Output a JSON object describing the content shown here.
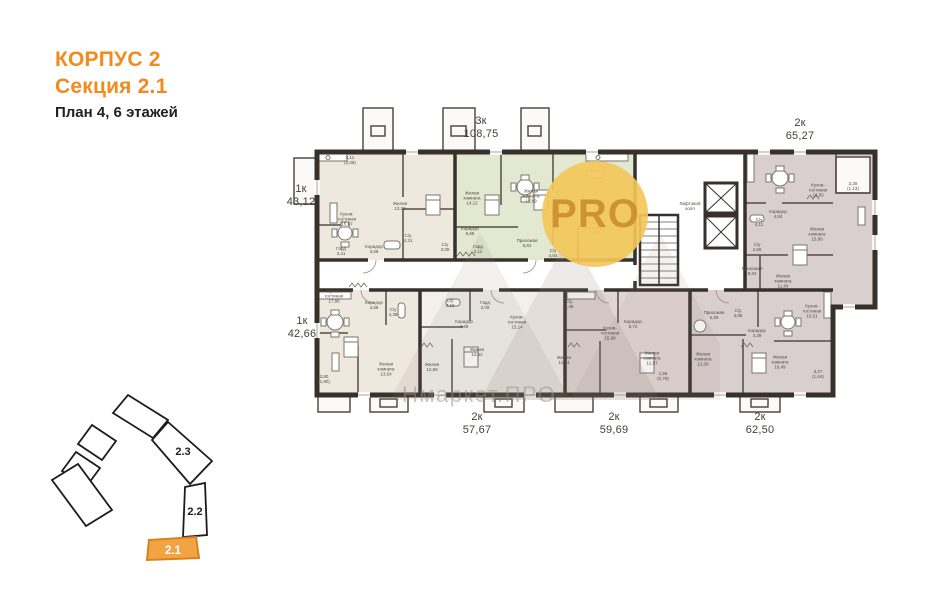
{
  "header": {
    "building": "КОРПУС 2",
    "section": "Секция 2.1",
    "plan": "План 4, 6 этажей"
  },
  "watermarks": {
    "pro_badge": "PRO",
    "site": "Нмаркет.ПРО"
  },
  "colors": {
    "accent_orange": "#f28a1d",
    "wall": "#38302a",
    "unit_beige": "#efe8de",
    "unit_green": "#e3e8d1",
    "unit_mauve": "#d9cfce",
    "unit_mauve_light": "#e0d6d4",
    "unit_white": "#f3f0ec",
    "pro_circle": "#f3c75a",
    "minimap_selected": "#f2a444"
  },
  "plan": {
    "unit_labels": [
      {
        "name": "unit-label-1k-43",
        "text": "1к\n43,12",
        "x": 301,
        "y": 196
      },
      {
        "name": "unit-label-3k-108",
        "text": "3к\n108,75",
        "x": 481,
        "y": 128
      },
      {
        "name": "unit-label-2k-65",
        "text": "2к\n65,27",
        "x": 800,
        "y": 130
      },
      {
        "name": "unit-label-1k-42",
        "text": "1к\n42,66",
        "x": 302,
        "y": 328
      },
      {
        "name": "unit-label-2k-57",
        "text": "2к\n57,67",
        "x": 477,
        "y": 424
      },
      {
        "name": "unit-label-2k-59",
        "text": "2к\n59,69",
        "x": 614,
        "y": 424
      },
      {
        "name": "unit-label-2k-62",
        "text": "2к\n62,50",
        "x": 760,
        "y": 424
      }
    ],
    "room_labels": [
      {
        "text": "Кухня-\nгостиная\n15,67",
        "x": 347,
        "y": 219
      },
      {
        "text": "Жилая\n13,99",
        "x": 400,
        "y": 206
      },
      {
        "text": "Коридор\n3,68",
        "x": 374,
        "y": 249
      },
      {
        "text": "Гард\n3,41",
        "x": 341,
        "y": 251
      },
      {
        "text": "С/у\n4,31",
        "x": 408,
        "y": 238
      },
      {
        "text": "4,11\n(2,06)",
        "x": 350,
        "y": 160
      },
      {
        "text": "Жилая\nкомната\n14,12",
        "x": 472,
        "y": 198
      },
      {
        "text": "Жилая\nкомната\n12,89",
        "x": 531,
        "y": 196
      },
      {
        "text": "Кухня-\nгостиная\n31,57",
        "x": 594,
        "y": 228
      },
      {
        "text": "Коридор\n5,65",
        "x": 470,
        "y": 231
      },
      {
        "text": "С/у\n3,09",
        "x": 445,
        "y": 247
      },
      {
        "text": "Гард\n2,11",
        "x": 478,
        "y": 249
      },
      {
        "text": "Прихожая\n5,81",
        "x": 527,
        "y": 243
      },
      {
        "text": "С/у\n4,54",
        "x": 553,
        "y": 253
      },
      {
        "text": "Лифтовой\nхолл",
        "x": 690,
        "y": 206
      },
      {
        "text": "Кухня-\nгостиная\n18,83",
        "x": 818,
        "y": 190
      },
      {
        "text": "Коридор\n4,84",
        "x": 778,
        "y": 214
      },
      {
        "text": "С/у\n4,11",
        "x": 759,
        "y": 222
      },
      {
        "text": "Жилая\nкомната\n15,80",
        "x": 817,
        "y": 234
      },
      {
        "text": "С/у\n2,56",
        "x": 757,
        "y": 247
      },
      {
        "text": "Прихожая\n8,34",
        "x": 752,
        "y": 271
      },
      {
        "text": "Жилая\nкомната\n11,84",
        "x": 783,
        "y": 281
      },
      {
        "text": "2,25\n(1,13)",
        "x": 853,
        "y": 186
      },
      {
        "text": "Кухня-\nгостиная\n17,86",
        "x": 334,
        "y": 296
      },
      {
        "text": "Коридор\n4,59",
        "x": 374,
        "y": 305
      },
      {
        "text": "С/у\n4,39",
        "x": 393,
        "y": 312
      },
      {
        "text": "Жилая\nкомната\n13,54",
        "x": 386,
        "y": 369
      },
      {
        "text": "3,80\n(1,90)",
        "x": 324,
        "y": 379
      },
      {
        "text": "С/у\n4,16",
        "x": 450,
        "y": 303
      },
      {
        "text": "Гард\n2,09",
        "x": 485,
        "y": 305
      },
      {
        "text": "Коридор\n4,69",
        "x": 464,
        "y": 324
      },
      {
        "text": "Кухня-\nгостиная\n15,14",
        "x": 517,
        "y": 322
      },
      {
        "text": "Жилая\n12,52",
        "x": 477,
        "y": 352
      },
      {
        "text": "Жилая\n12,58",
        "x": 432,
        "y": 367
      },
      {
        "text": "С/у\n4,48",
        "x": 569,
        "y": 304
      },
      {
        "text": "Коридор\n5,72",
        "x": 633,
        "y": 324
      },
      {
        "text": "Кухня-\nгостиная\n15,68",
        "x": 610,
        "y": 333
      },
      {
        "text": "Жилая\n11,24",
        "x": 564,
        "y": 360
      },
      {
        "text": "Жилая\nкомната\n11,97",
        "x": 652,
        "y": 358
      },
      {
        "text": "1,56\n(0,78)",
        "x": 663,
        "y": 376
      },
      {
        "text": "С/у\n4,05",
        "x": 738,
        "y": 313
      },
      {
        "text": "Прихожая\n5,29",
        "x": 714,
        "y": 315
      },
      {
        "text": "Кухня-\nгостиная\n16,51",
        "x": 812,
        "y": 311
      },
      {
        "text": "Коридор\n4,39",
        "x": 757,
        "y": 333
      },
      {
        "text": "Жилая\nкомната\n12,08",
        "x": 703,
        "y": 359
      },
      {
        "text": "Жилая\nкомната\n16,49",
        "x": 780,
        "y": 362
      },
      {
        "text": "3,27\n(1,64)",
        "x": 818,
        "y": 374
      }
    ]
  },
  "minimap": {
    "labels": [
      {
        "name": "minimap-label-2-3",
        "text": "2.3",
        "x": 183,
        "y": 452,
        "cls": "dark"
      },
      {
        "name": "minimap-label-2-2",
        "text": "2.2",
        "x": 195,
        "y": 512,
        "cls": "dark"
      },
      {
        "name": "minimap-label-2-1",
        "text": "2.1",
        "x": 173,
        "y": 551,
        "cls": "light"
      }
    ]
  }
}
